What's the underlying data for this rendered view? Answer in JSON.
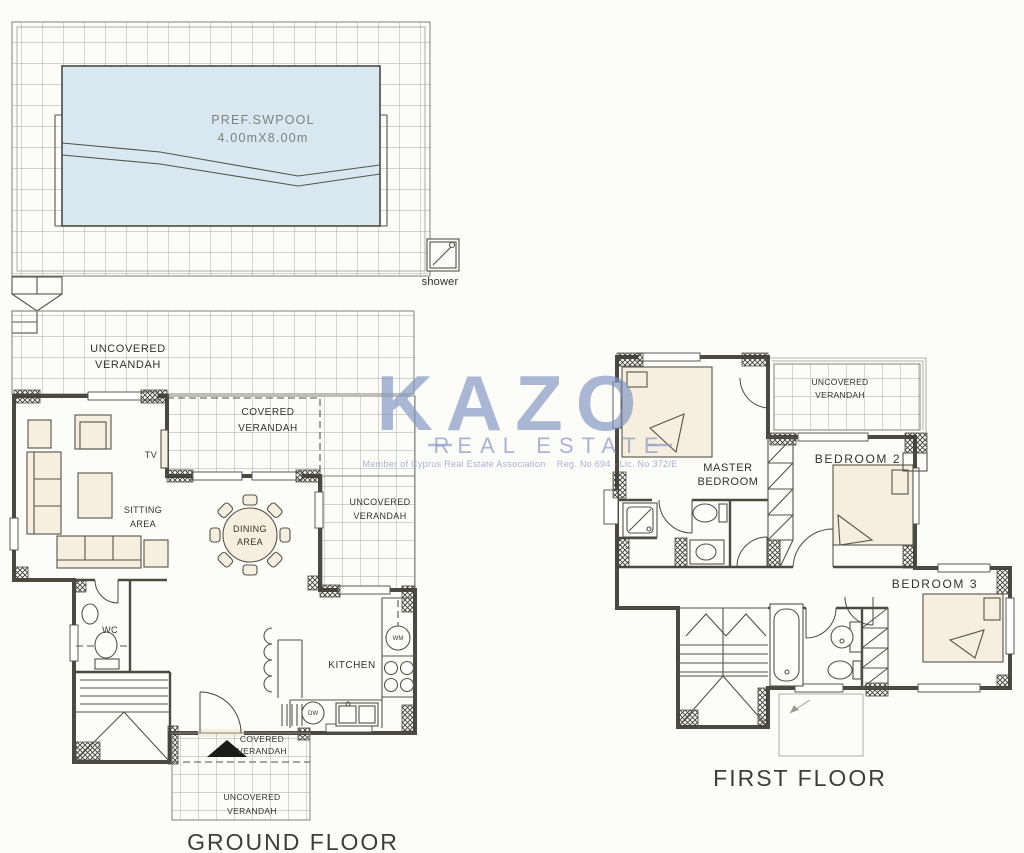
{
  "palette": {
    "room_fill": "#f6eede",
    "pool_fill": "#d9e8f0",
    "wall_line": "#4a4a42",
    "grid_line": "#8e8e85",
    "watermark_blue": "#8397c3",
    "page_bg": "#fcfcf9"
  },
  "watermark": {
    "brand": "KAZO",
    "tagline": "REAL ESTATE",
    "legal": "Member of Cyprus Real Estate Association    Reg. No 694 - Lic. No 372/E"
  },
  "ground_floor": {
    "title": "GROUND FLOOR",
    "pool": {
      "name_line": "PREF.SWPOOL",
      "size_line": "4.00mX8.00m"
    },
    "shower_label": "shower",
    "verandah_top": [
      "UNCOVERED",
      "VERANDAH"
    ],
    "covered_verandah": [
      "COVERED",
      "VERANDAH"
    ],
    "verandah_right": [
      "UNCOVERED",
      "VERANDAH"
    ],
    "sitting_area": [
      "SITTING",
      "AREA"
    ],
    "dining_area": [
      "DINING",
      "AREA"
    ],
    "tv_label": "TV",
    "wc_label": "WC",
    "kitchen_label": "KITCHEN",
    "washing_machine_label": "WM",
    "dishwasher_label": "DW",
    "covered_verandah_entrance": [
      "COVERED",
      "VERANDAH"
    ],
    "verandah_bottom": [
      "UNCOVERED",
      "VERANDAH"
    ]
  },
  "first_floor": {
    "title": "FIRST FLOOR",
    "master_bedroom": [
      "MASTER",
      "BEDROOM"
    ],
    "bedroom_2": "BEDROOM 2",
    "bedroom_3": "BEDROOM 3",
    "verandah": [
      "UNCOVERED",
      "VERANDAH"
    ]
  }
}
